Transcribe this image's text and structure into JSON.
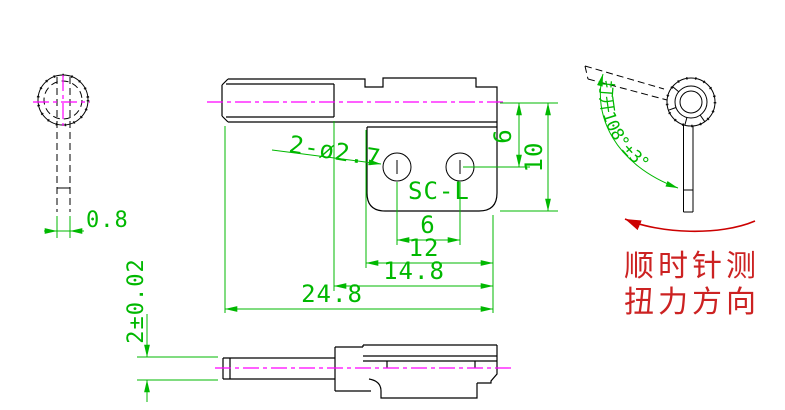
{
  "drawing": {
    "kind": "CAD engineering drawing of torsion spring bracket",
    "views": {
      "left": {
        "stem_width": "0.8"
      },
      "front": {
        "holes_callout": "2-ø2.7",
        "part_label": "SC-L",
        "hole_spacing": "6",
        "width_step": "12",
        "width_flat": "14.8",
        "width_total": "24.8",
        "hole_offset_height": "6",
        "body_height": "10"
      },
      "side": {
        "thickness": "2±0.02"
      },
      "angle": {
        "open_angle": "打开108°±3°",
        "torque_note_line1": "顺时针测",
        "torque_note_line2": "扭力方向"
      }
    },
    "colors": {
      "outline": "#000000",
      "dimension_green": "#00b800",
      "centerline_magenta": "#ff00ff",
      "annotation_red": "#cc2222",
      "background": "#ffffff"
    }
  }
}
